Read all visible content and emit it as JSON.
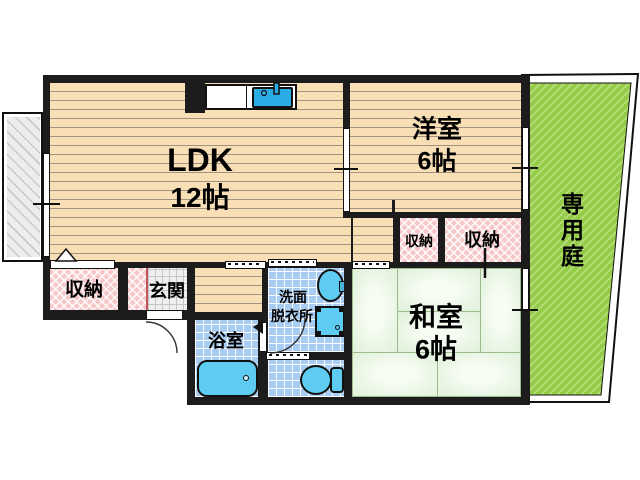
{
  "rooms": {
    "ldk": {
      "name": "LDK",
      "size": "12帖"
    },
    "western_room": {
      "name": "洋室",
      "size": "6帖"
    },
    "japanese_room": {
      "name": "和室",
      "size": "6帖"
    },
    "private_garden": {
      "name": "専用庭"
    },
    "storage_ldk": {
      "name": "収納"
    },
    "storage_mid": {
      "name": "収納"
    },
    "storage_right": {
      "name": "収納"
    },
    "entrance": {
      "name": "玄関"
    },
    "washroom": {
      "line1": "洗面",
      "line2": "脱衣所"
    },
    "bathroom": {
      "name": "浴室"
    }
  },
  "colors": {
    "wall": "#1c1c1c",
    "wood_floor": "#f8dfb6",
    "tatami_green": "#e9f5e3",
    "storage_pink": "#f6c6c9",
    "wet_tile_blue": "#a9cdf2",
    "fixture_blue": "#5ecbf2",
    "kitchen_sink_blue": "#2aace4",
    "garden_green": "#94cb47",
    "balcony_gray": "#ededed"
  }
}
